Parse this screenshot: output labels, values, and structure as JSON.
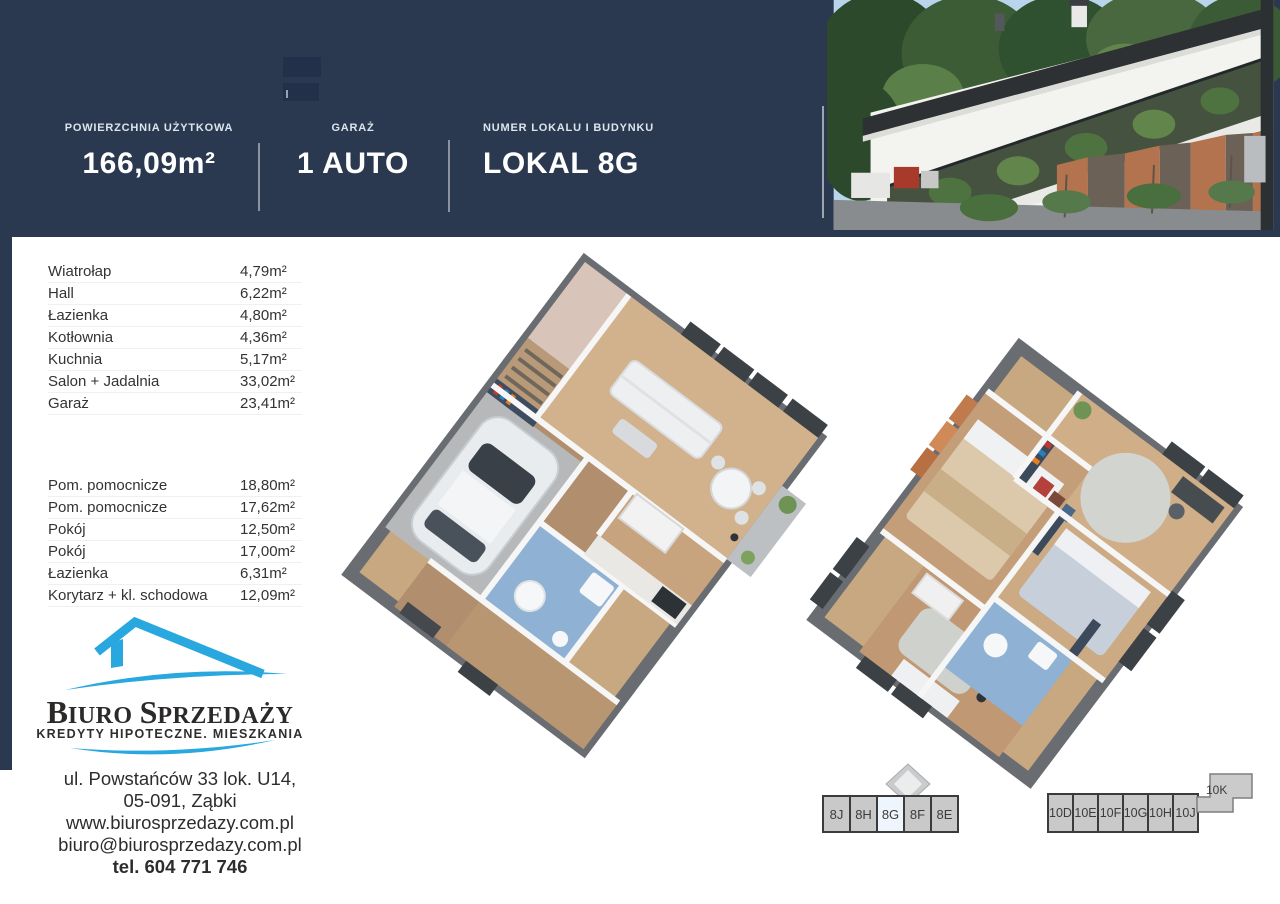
{
  "header": {
    "bg_color": "#2b3950",
    "stats": [
      {
        "label": "POWIERZCHNIA UŻYTKOWA",
        "value": "166,09m²"
      },
      {
        "label": "GARAŻ",
        "value": "1 AUTO"
      },
      {
        "label": "NUMER LOKALU I BUDYNKU",
        "value": "LOKAL 8G"
      }
    ],
    "photo": "building-exterior-photo"
  },
  "room_tables": {
    "ground_floor": [
      {
        "name": "Wiatrołap",
        "area": "4,79m²"
      },
      {
        "name": "Hall",
        "area": "6,22m²"
      },
      {
        "name": "Łazienka",
        "area": "4,80m²"
      },
      {
        "name": "Kotłownia",
        "area": "4,36m²"
      },
      {
        "name": "Kuchnia",
        "area": "5,17m²"
      },
      {
        "name": "Salon + Jadalnia",
        "area": "33,02m²"
      },
      {
        "name": "Garaż",
        "area": "23,41m²"
      }
    ],
    "upper_floor": [
      {
        "name": "Pom. pomocnicze",
        "area": "18,80m²"
      },
      {
        "name": "Pom. pomocnicze",
        "area": "17,62m²"
      },
      {
        "name": "Pokój",
        "area": "12,50m²"
      },
      {
        "name": "Pokój",
        "area": "17,00m²"
      },
      {
        "name": "Łazienka",
        "area": "6,31m²"
      },
      {
        "name": "Korytarz + kl. schodowa",
        "area": "12,09m²"
      }
    ]
  },
  "logo": {
    "word1_initial": "B",
    "word1_rest": "IURO",
    "word2_initial": "S",
    "word2_rest": "PRZEDAŻY",
    "subtitle": "KREDYTY HIPOTECZNE. MIESZKANIA",
    "brand_color": "#29a8e0",
    "icon": "house-roof-icon"
  },
  "contact": {
    "address_line1": "ul. Powstańców 33 lok. U14,",
    "address_line2": "05-091, Ząbki",
    "website": "www.biurosprzedazy.com.pl",
    "email": "biuro@biurosprzedazy.com.pl",
    "phone": "tel. 604 771 746"
  },
  "unit_selectors": {
    "building8": {
      "units": [
        "8J",
        "8H",
        "8G",
        "8F",
        "8E"
      ],
      "active": "8G"
    },
    "building10": {
      "units": [
        "10D",
        "10E",
        "10F",
        "10G",
        "10H",
        "10J"
      ],
      "offset_unit": "10K"
    }
  },
  "floorplans": {
    "plan1": "ground-floor-3d-plan",
    "plan2": "upper-floor-3d-plan"
  }
}
